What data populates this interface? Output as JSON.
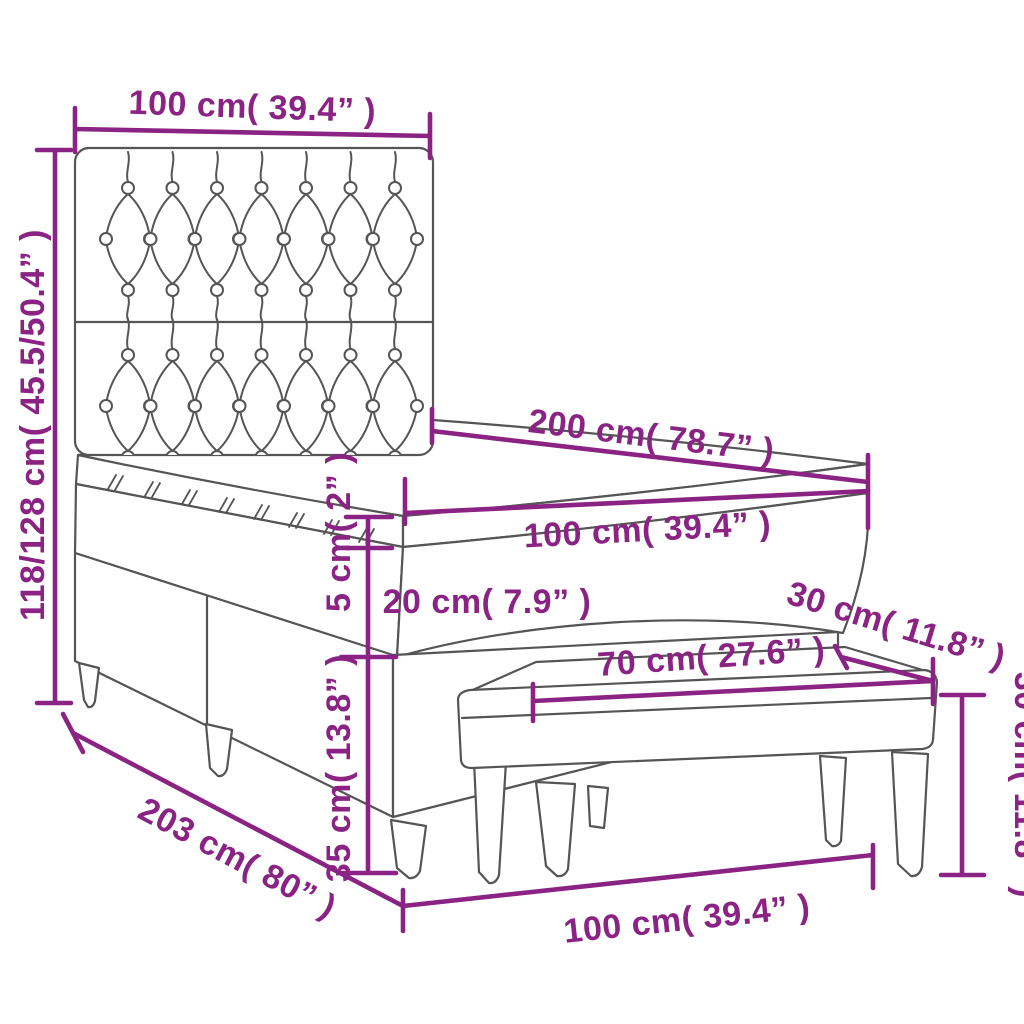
{
  "diagram": {
    "type": "product-dimension-diagram",
    "product": "box-spring-bed-with-tufted-headboard-topper-and-bench",
    "accent_color": "#8A2383",
    "line_color": "#555555",
    "background_color": "#ffffff",
    "labels": {
      "headboard_width": "100 cm( 39.4” )",
      "overall_height": "118/128 cm( 45.5/50.4” )",
      "mattress_length": "200 cm( 78.7” )",
      "mattress_width": "100 cm( 39.4” )",
      "topper_thickness": "5 cm( 2” )",
      "mattress_thickness": "20 cm( 7.9” )",
      "base_height": "35 cm( 13.8” )",
      "overall_length": "203 cm( 80” )",
      "bed_bottom_width": "100 cm( 39.4” )",
      "bench_length": "70 cm( 27.6” )",
      "bench_depth": "30 cm( 11.8” )",
      "bench_height": "30 cm( 11.8” )"
    }
  }
}
